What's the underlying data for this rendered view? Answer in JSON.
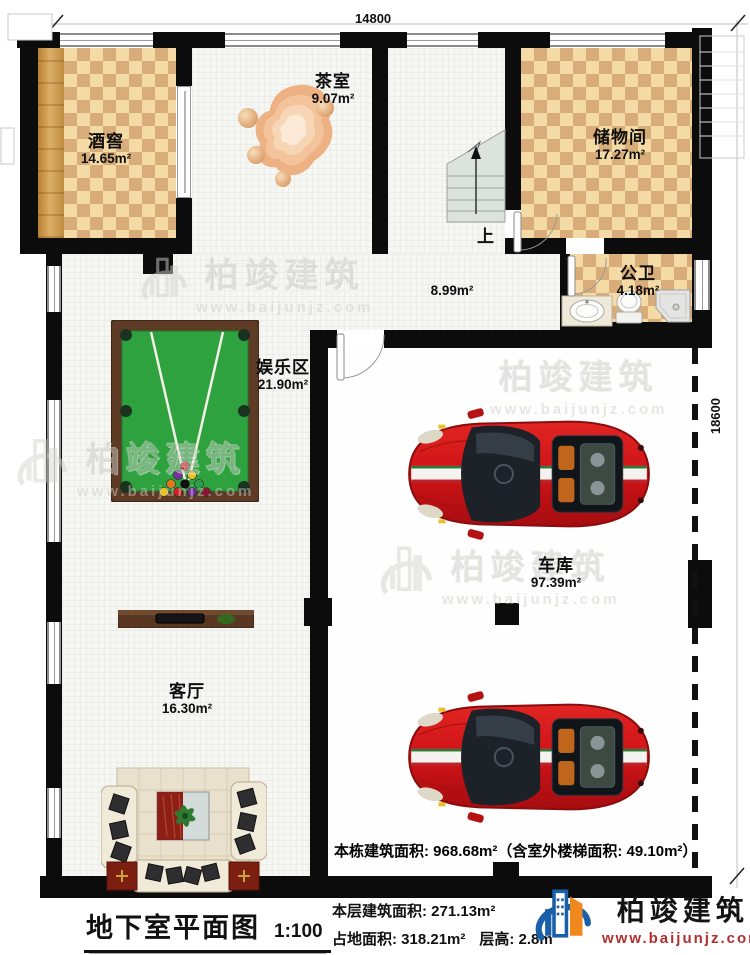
{
  "plan": {
    "dimensions": {
      "top_width": "14800",
      "right_height": "18600"
    },
    "rooms": {
      "wine_cellar": {
        "name": "酒窖",
        "area": "14.65m²"
      },
      "tea_room": {
        "name": "茶室",
        "area": "9.07m²"
      },
      "storage_room": {
        "name": "储物间",
        "area": "17.27m²"
      },
      "public_bathroom": {
        "name": "公卫",
        "area": "4.18m²"
      },
      "hallway": {
        "area": "8.99m²"
      },
      "entertainment_area": {
        "name": "娱乐区",
        "area": "21.90m²"
      },
      "garage": {
        "name": "车库",
        "area": "97.39m²"
      },
      "living_room": {
        "name": "客厅",
        "area": "16.30m²"
      }
    },
    "stairs": {
      "direction_label": "上"
    },
    "garage_note": "本栋建筑面积: 968.68m²（含室外楼梯面积: 49.10m²）"
  },
  "title_block": {
    "title": "地下室平面图",
    "scale": "1:100",
    "floor_area": "本层建筑面积: 271.13m²",
    "footprint": "占地面积: 318.21m²",
    "floor_height": "层高: 2.8m"
  },
  "branding": {
    "company": "柏竣建筑",
    "website": "www.baijunjz.com"
  },
  "watermark": {
    "company": "柏竣建筑",
    "website": "www.baijunjz.com"
  },
  "colors": {
    "wall": "#0c0c0c",
    "checker_light": "#f4daa5",
    "checker_dark": "#d8ad79",
    "felt_green": "#2ea23e",
    "car_red": "#cf1317",
    "logo_blue": "#1a5fa8",
    "logo_orange": "#f0891d",
    "website_red": "#b03030"
  }
}
